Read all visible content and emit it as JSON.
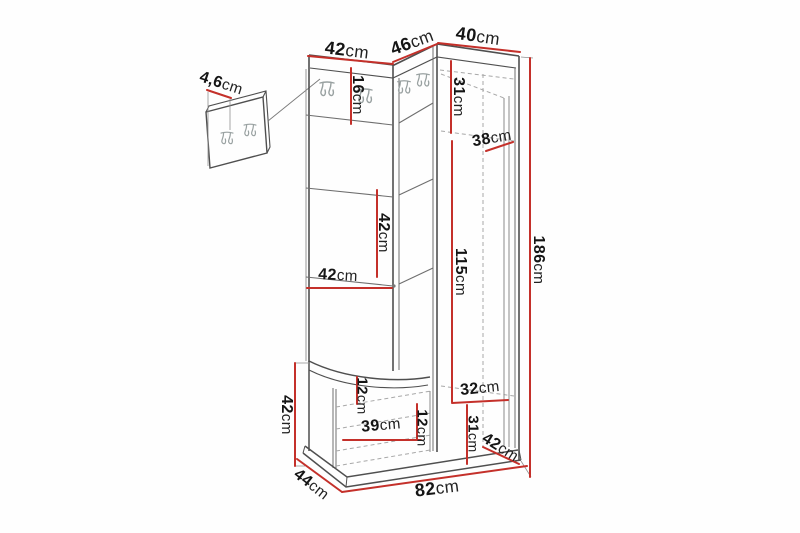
{
  "diagram": {
    "description": "Dimension drawing of a corner hallway furniture set: coat-hook panel, open shelves, seat bench and corner wardrobe, plus a separate wall-mounted hook panel",
    "unit": "cm",
    "colors": {
      "dimension_line": "#c4302a",
      "outline": "#4f4f4f",
      "seam_line": "#6e6e6e",
      "dashed_interior": "#a8a8a8",
      "label_text": "#151515",
      "hook_icon": "#99a1a1",
      "background": "#fefefe"
    },
    "labels": [
      {
        "name": "wall-panel-thickness",
        "value": "4,6",
        "unit": "cm"
      },
      {
        "name": "top-width-left-section",
        "value": "42",
        "unit": "cm"
      },
      {
        "name": "top-width-corner-section",
        "value": "46",
        "unit": "cm"
      },
      {
        "name": "top-width-wardrobe",
        "value": "40",
        "unit": "cm"
      },
      {
        "name": "hook-panel-height",
        "value": "16",
        "unit": "cm"
      },
      {
        "name": "wardrobe-top-inner-height",
        "value": "31",
        "unit": "cm"
      },
      {
        "name": "wardrobe-shelf-depth",
        "value": "38",
        "unit": "cm"
      },
      {
        "name": "middle-shelf-height",
        "value": "42",
        "unit": "cm"
      },
      {
        "name": "middle-shelf-width",
        "value": "42",
        "unit": "cm"
      },
      {
        "name": "wardrobe-inner-height",
        "value": "115",
        "unit": "cm"
      },
      {
        "name": "total-height",
        "value": "186",
        "unit": "cm"
      },
      {
        "name": "bench-height",
        "value": "42",
        "unit": "cm"
      },
      {
        "name": "seat-board-height",
        "value": "12",
        "unit": "cm"
      },
      {
        "name": "lower-niche-width",
        "value": "32",
        "unit": "cm"
      },
      {
        "name": "bench-inner-width",
        "value": "39",
        "unit": "cm"
      },
      {
        "name": "bench-shelf-height",
        "value": "12",
        "unit": "cm"
      },
      {
        "name": "lower-niche-height",
        "value": "31",
        "unit": "cm"
      },
      {
        "name": "lower-corner-depth",
        "value": "42",
        "unit": "cm"
      },
      {
        "name": "bench-depth",
        "value": "44",
        "unit": "cm"
      },
      {
        "name": "total-width",
        "value": "82",
        "unit": "cm"
      }
    ]
  }
}
